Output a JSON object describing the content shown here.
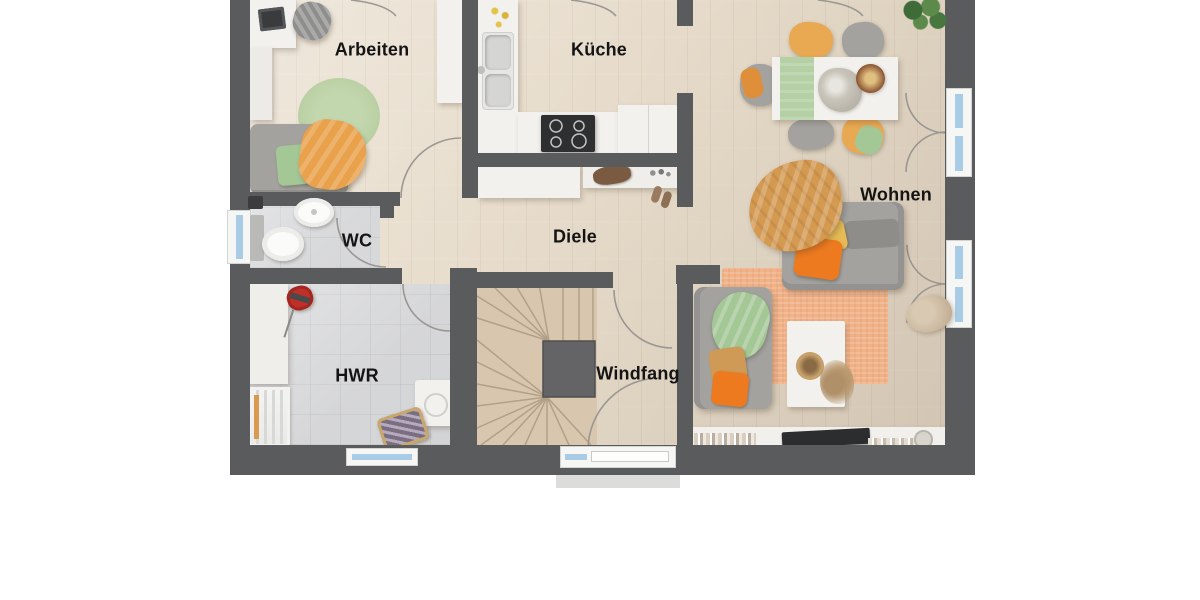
{
  "plan": {
    "type": "floor-plan",
    "language": "de",
    "rooms": {
      "arbeiten": {
        "label": "Arbeiten"
      },
      "kueche": {
        "label": "Küche"
      },
      "wohnen": {
        "label": "Wohnen"
      },
      "wc": {
        "label": "WC"
      },
      "diele": {
        "label": "Diele"
      },
      "hwr": {
        "label": "HWR"
      },
      "windfang": {
        "label": "Windfang"
      }
    }
  },
  "colors": {
    "wall": "#5a5b5d",
    "floor_wood": "#e7dccb",
    "floor_tile": "#d6d7d9",
    "stairs_wood": "#d8c6ae",
    "counter_white": "#f2f1ee",
    "window_glass": "#a9cce6",
    "rug_living": "#f1b288",
    "rug_green": "#b9cfa3",
    "sofa_grey": "#a3a29f",
    "accent_orange": "#ed7a1f",
    "accent_mustard": "#d59a52",
    "accent_chair_orange": "#e9a852",
    "accent_green": "#a4c796",
    "vacuum_red": "#c03028",
    "cooktop_black": "#2e2f31"
  }
}
